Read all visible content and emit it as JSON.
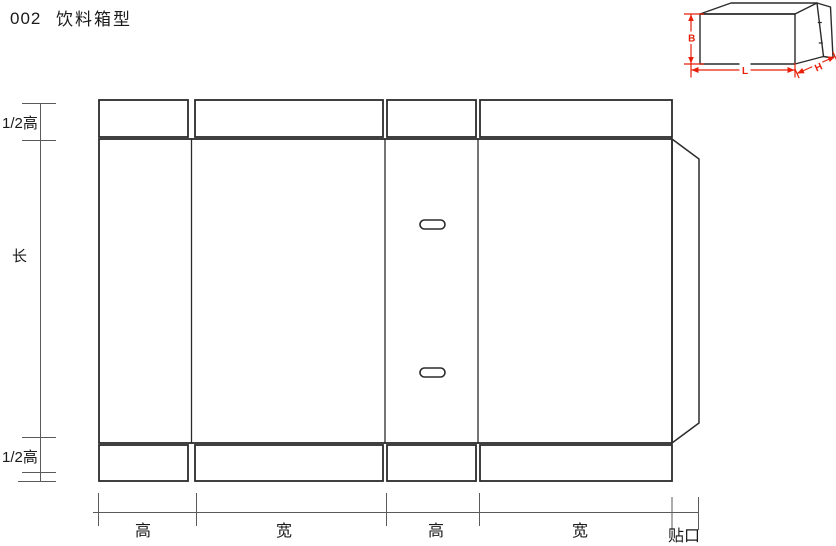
{
  "title": {
    "number": "002",
    "name": "饮料箱型"
  },
  "preview_3d": {
    "height_label": "B",
    "length_label": "L",
    "depth_label": "H"
  },
  "left_dimension": {
    "labels": [
      "1/2高",
      "长",
      "1/2高"
    ]
  },
  "bottom_dimension": {
    "labels": [
      "高",
      "宽",
      "高",
      "宽"
    ],
    "glue_label": "贴口"
  },
  "colors": {
    "outline": "#2b2b2b",
    "dimension_line": "#5a5a5a",
    "dimension_red": "#e8200a",
    "text": "#1a1a1a",
    "background": "#ffffff"
  }
}
